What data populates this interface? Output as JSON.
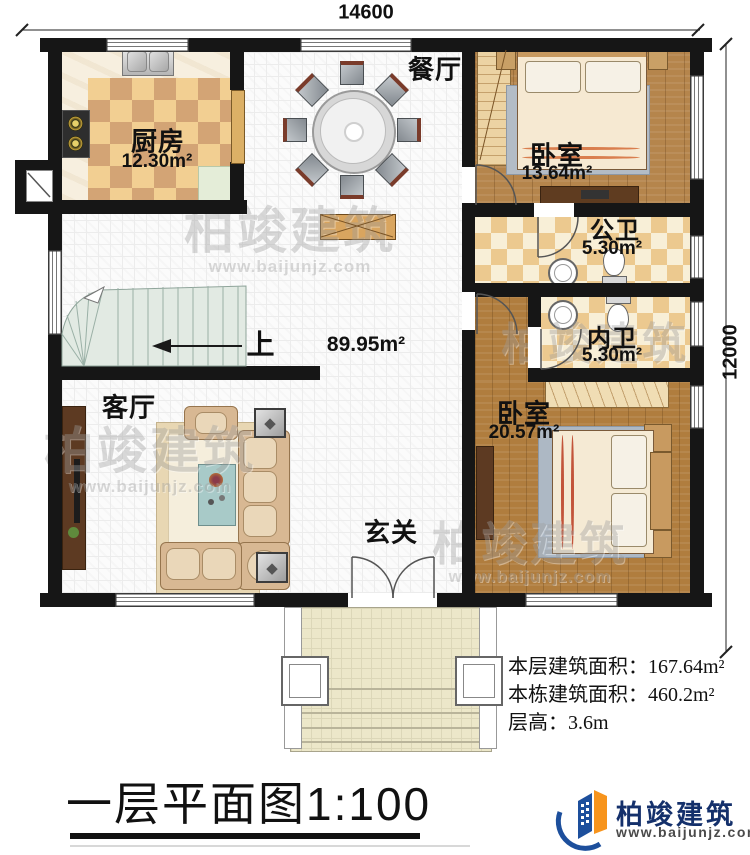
{
  "dimensions": {
    "top": "14600",
    "right": "12000"
  },
  "rooms": {
    "kitchen": {
      "name": "厨房",
      "area": "12.30m²"
    },
    "dining": {
      "name": "餐厅"
    },
    "bedroom1": {
      "name": "卧室",
      "area": "13.64m²"
    },
    "public_bath": {
      "name": "公卫",
      "area": "5.30m²"
    },
    "private_bath": {
      "name": "内卫",
      "area": "5.30m²"
    },
    "bedroom2": {
      "name": "卧室",
      "area": "20.57m²"
    },
    "living": {
      "name": "客厅"
    },
    "foyer": {
      "name": "玄关"
    }
  },
  "stairs": {
    "direction_label": "上"
  },
  "open_area_label": "89.95m²",
  "info": {
    "line1": "本层建筑面积：167.64m²",
    "line2": "本栋建筑面积：460.2m²",
    "line3": "层高：3.6m"
  },
  "title": "一层平面图1:100",
  "logo": {
    "brand": "柏竣建筑",
    "url": "www.baijunjz.com"
  },
  "watermark": {
    "brand": "柏竣建筑",
    "url": "www.baijunjz.com"
  },
  "colors": {
    "wall": "#161616",
    "logo_blue": "#1d4f9c",
    "logo_orange": "#f7941d"
  }
}
